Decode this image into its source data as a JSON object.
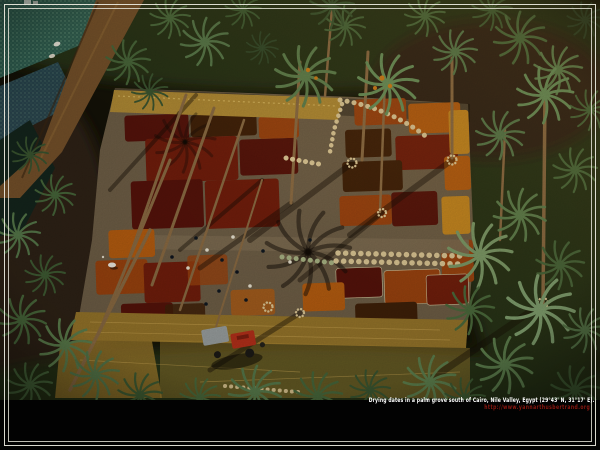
{
  "window": {
    "width": 600,
    "height": 450,
    "background": "#000000"
  },
  "caption": {
    "line1": "Drying dates in a palm grove south of Cairo, Nile Valley, Egypt (29°43' N, 31°17' E).",
    "line2": "http://www.yannarthusbertrand.org",
    "color_line1": "#ffffff",
    "color_line2": "#8c1710"
  },
  "frame": {
    "color": "#eceadf"
  },
  "photo": {
    "alt": "Aerial photograph of dates drying in coloured rectangular patches on a cleared field inside a date-palm grove, with workers, sacks, a tractor, a dirt road and irrigated crop fields",
    "palette": {
      "base_dark": "#141207",
      "grove_green": "#263317",
      "grove_brown": "#2e2412",
      "field_ground": "#6e5e46",
      "path_grey": "#7a6950",
      "patch_maroon": "#55130a",
      "patch_darkred": "#701d0b",
      "patch_rust": "#99420f",
      "patch_orange": "#b45c10",
      "patch_amber": "#c4861f",
      "patch_darkbrown": "#3f2008",
      "straw_gold": "#b08a34",
      "straw_dark": "#96752a",
      "road_brown": "#75512a",
      "teal_field": "#2f5e50",
      "blue_field": "#2b4a55",
      "canal_dark": "#14251d",
      "sack_cream": "#dcc795",
      "sack_green": "#a8b383",
      "tractor_red": "#b5301a",
      "trailer_grey": "#9aa0a0",
      "trunk_tan": "#8a6a42",
      "date_orange": "#cf7d18"
    }
  }
}
